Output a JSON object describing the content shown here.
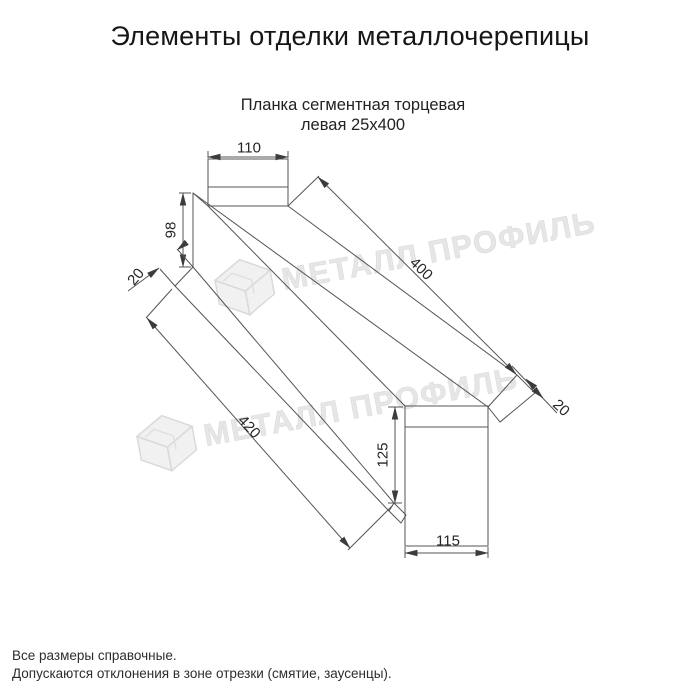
{
  "title": "Элементы отделки металлочерепицы",
  "product": {
    "name_line1": "Планка сегментная торцевая",
    "name_line2": "левая 25x400"
  },
  "dimensions": {
    "top_width": "110",
    "left_height": "98",
    "left_fold": "20",
    "length_top": "400",
    "length_bottom": "420",
    "right_fold": "20",
    "bottom_height": "125",
    "bottom_width": "115"
  },
  "watermark": {
    "text": "МЕТАЛЛ ПРОФИЛЬ"
  },
  "footer": {
    "note1": "Все размеры справочные.",
    "note2": "Допускаются отклонения в зоне отрезки (смятие, заусенцы)."
  },
  "colors": {
    "line": "#555555",
    "arrow": "#3c3c3c",
    "watermark_fill": "#e4e4e4",
    "watermark_stroke": "#d6d6d6"
  }
}
